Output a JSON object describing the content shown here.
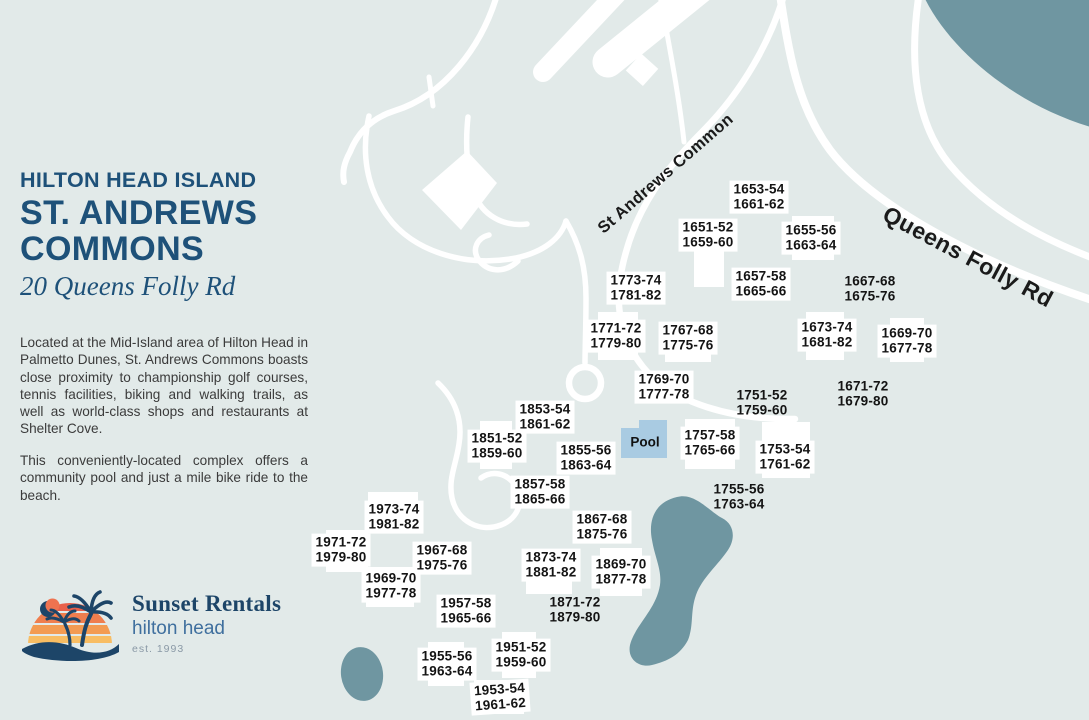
{
  "colors": {
    "bg": "#e2eae9",
    "water": "#6f96a1",
    "road": "#ffffff",
    "pool": "#a9cbe2",
    "heading": "#1e5179",
    "navy": "#1d4568",
    "logoblue": "#3f6f9e",
    "body": "#3b3b3b"
  },
  "panel": {
    "region_heading": "HILTON HEAD ISLAND",
    "title_line1": "ST. ANDREWS",
    "title_line2": "COMMONS",
    "address": "20 Queens Folly Rd",
    "paragraphs": [
      "Located at the Mid-Island area of Hilton Head in Palmetto Dunes, St. Andrews Commons boasts close proximity to championship golf courses, tennis facilities, biking and walking trails, as well as world-class shops and restaurants at Shelter Cove.",
      "This conveniently-located complex offers a community pool and just a mile bike ride to the beach."
    ],
    "logo": {
      "name": "Sunset Rentals",
      "location": "hilton head",
      "established": "est. 1993"
    }
  },
  "map": {
    "road_labels": [
      {
        "text": "St Andrews Common",
        "x": 666,
        "y": 174,
        "rotation": -41
      },
      {
        "text": "Queens Folly Rd",
        "x": 968,
        "y": 257,
        "rotation": 28
      }
    ],
    "pool": {
      "label": "Pool",
      "x": 645,
      "y": 442
    },
    "unit_labels": [
      {
        "lines": [
          "1653-54",
          "1661-62"
        ],
        "x": 759,
        "y": 197,
        "bg": true
      },
      {
        "lines": [
          "1651-52",
          "1659-60"
        ],
        "x": 708,
        "y": 235,
        "bg": true
      },
      {
        "lines": [
          "1655-56",
          "1663-64"
        ],
        "x": 811,
        "y": 238,
        "bg": true
      },
      {
        "lines": [
          "1773-74",
          "1781-82"
        ],
        "x": 636,
        "y": 288,
        "bg": true
      },
      {
        "lines": [
          "1657-58",
          "1665-66"
        ],
        "x": 761,
        "y": 284,
        "bg": true
      },
      {
        "lines": [
          "1667-68",
          "1675-76"
        ],
        "x": 870,
        "y": 289,
        "bg": false
      },
      {
        "lines": [
          "1771-72",
          "1779-80"
        ],
        "x": 616,
        "y": 336,
        "bg": true
      },
      {
        "lines": [
          "1767-68",
          "1775-76"
        ],
        "x": 688,
        "y": 338,
        "bg": true
      },
      {
        "lines": [
          "1673-74",
          "1681-82"
        ],
        "x": 827,
        "y": 335,
        "bg": true
      },
      {
        "lines": [
          "1669-70",
          "1677-78"
        ],
        "x": 907,
        "y": 341,
        "bg": true
      },
      {
        "lines": [
          "1769-70",
          "1777-78"
        ],
        "x": 664,
        "y": 387,
        "bg": true
      },
      {
        "lines": [
          "1751-52",
          "1759-60"
        ],
        "x": 762,
        "y": 403,
        "bg": false
      },
      {
        "lines": [
          "1671-72",
          "1679-80"
        ],
        "x": 863,
        "y": 394,
        "bg": false
      },
      {
        "lines": [
          "1853-54",
          "1861-62"
        ],
        "x": 545,
        "y": 417,
        "bg": true
      },
      {
        "lines": [
          "1851-52",
          "1859-60"
        ],
        "x": 497,
        "y": 446,
        "bg": true
      },
      {
        "lines": [
          "1855-56",
          "1863-64"
        ],
        "x": 586,
        "y": 458,
        "bg": true
      },
      {
        "lines": [
          "1757-58",
          "1765-66"
        ],
        "x": 710,
        "y": 443,
        "bg": true
      },
      {
        "lines": [
          "1753-54",
          "1761-62"
        ],
        "x": 785,
        "y": 457,
        "bg": true
      },
      {
        "lines": [
          "1857-58",
          "1865-66"
        ],
        "x": 540,
        "y": 492,
        "bg": true
      },
      {
        "lines": [
          "1755-56",
          "1763-64"
        ],
        "x": 739,
        "y": 497,
        "bg": false
      },
      {
        "lines": [
          "1867-68",
          "1875-76"
        ],
        "x": 602,
        "y": 527,
        "bg": true
      },
      {
        "lines": [
          "1973-74",
          "1981-82"
        ],
        "x": 394,
        "y": 517,
        "bg": true
      },
      {
        "lines": [
          "1971-72",
          "1979-80"
        ],
        "x": 341,
        "y": 550,
        "bg": true
      },
      {
        "lines": [
          "1967-68",
          "1975-76"
        ],
        "x": 442,
        "y": 558,
        "bg": true
      },
      {
        "lines": [
          "1873-74",
          "1881-82"
        ],
        "x": 551,
        "y": 565,
        "bg": true
      },
      {
        "lines": [
          "1869-70",
          "1877-78"
        ],
        "x": 621,
        "y": 572,
        "bg": true
      },
      {
        "lines": [
          "1969-70",
          "1977-78"
        ],
        "x": 391,
        "y": 586,
        "bg": true
      },
      {
        "lines": [
          "1957-58",
          "1965-66"
        ],
        "x": 466,
        "y": 611,
        "bg": true
      },
      {
        "lines": [
          "1871-72",
          "1879-80"
        ],
        "x": 575,
        "y": 610,
        "bg": false
      },
      {
        "lines": [
          "1955-56",
          "1963-64"
        ],
        "x": 447,
        "y": 664,
        "bg": true
      },
      {
        "lines": [
          "1951-52",
          "1959-60"
        ],
        "x": 521,
        "y": 655,
        "bg": true
      },
      {
        "lines": [
          "1953-54",
          "1961-62"
        ],
        "x": 500,
        "y": 697,
        "bg": true,
        "rot": -4
      }
    ],
    "buildings": [
      {
        "x": 694,
        "y": 247,
        "w": 30,
        "h": 40
      },
      {
        "x": 792,
        "y": 216,
        "w": 42,
        "h": 44
      },
      {
        "x": 598,
        "y": 312,
        "w": 40,
        "h": 48
      },
      {
        "x": 665,
        "y": 322,
        "w": 46,
        "h": 40
      },
      {
        "x": 806,
        "y": 312,
        "w": 38,
        "h": 48
      },
      {
        "x": 890,
        "y": 318,
        "w": 34,
        "h": 44
      },
      {
        "x": 480,
        "y": 421,
        "w": 32,
        "h": 48
      },
      {
        "x": 685,
        "y": 419,
        "w": 50,
        "h": 50
      },
      {
        "x": 762,
        "y": 422,
        "w": 48,
        "h": 56
      },
      {
        "x": 600,
        "y": 548,
        "w": 42,
        "h": 48
      },
      {
        "x": 368,
        "y": 492,
        "w": 50,
        "h": 40
      },
      {
        "x": 326,
        "y": 530,
        "w": 42,
        "h": 42
      },
      {
        "x": 366,
        "y": 567,
        "w": 48,
        "h": 40
      },
      {
        "x": 526,
        "y": 550,
        "w": 46,
        "h": 44
      },
      {
        "x": 502,
        "y": 632,
        "w": 34,
        "h": 46
      },
      {
        "x": 428,
        "y": 642,
        "w": 36,
        "h": 44
      },
      {
        "x": 474,
        "y": 680,
        "w": 50,
        "h": 34
      }
    ]
  }
}
